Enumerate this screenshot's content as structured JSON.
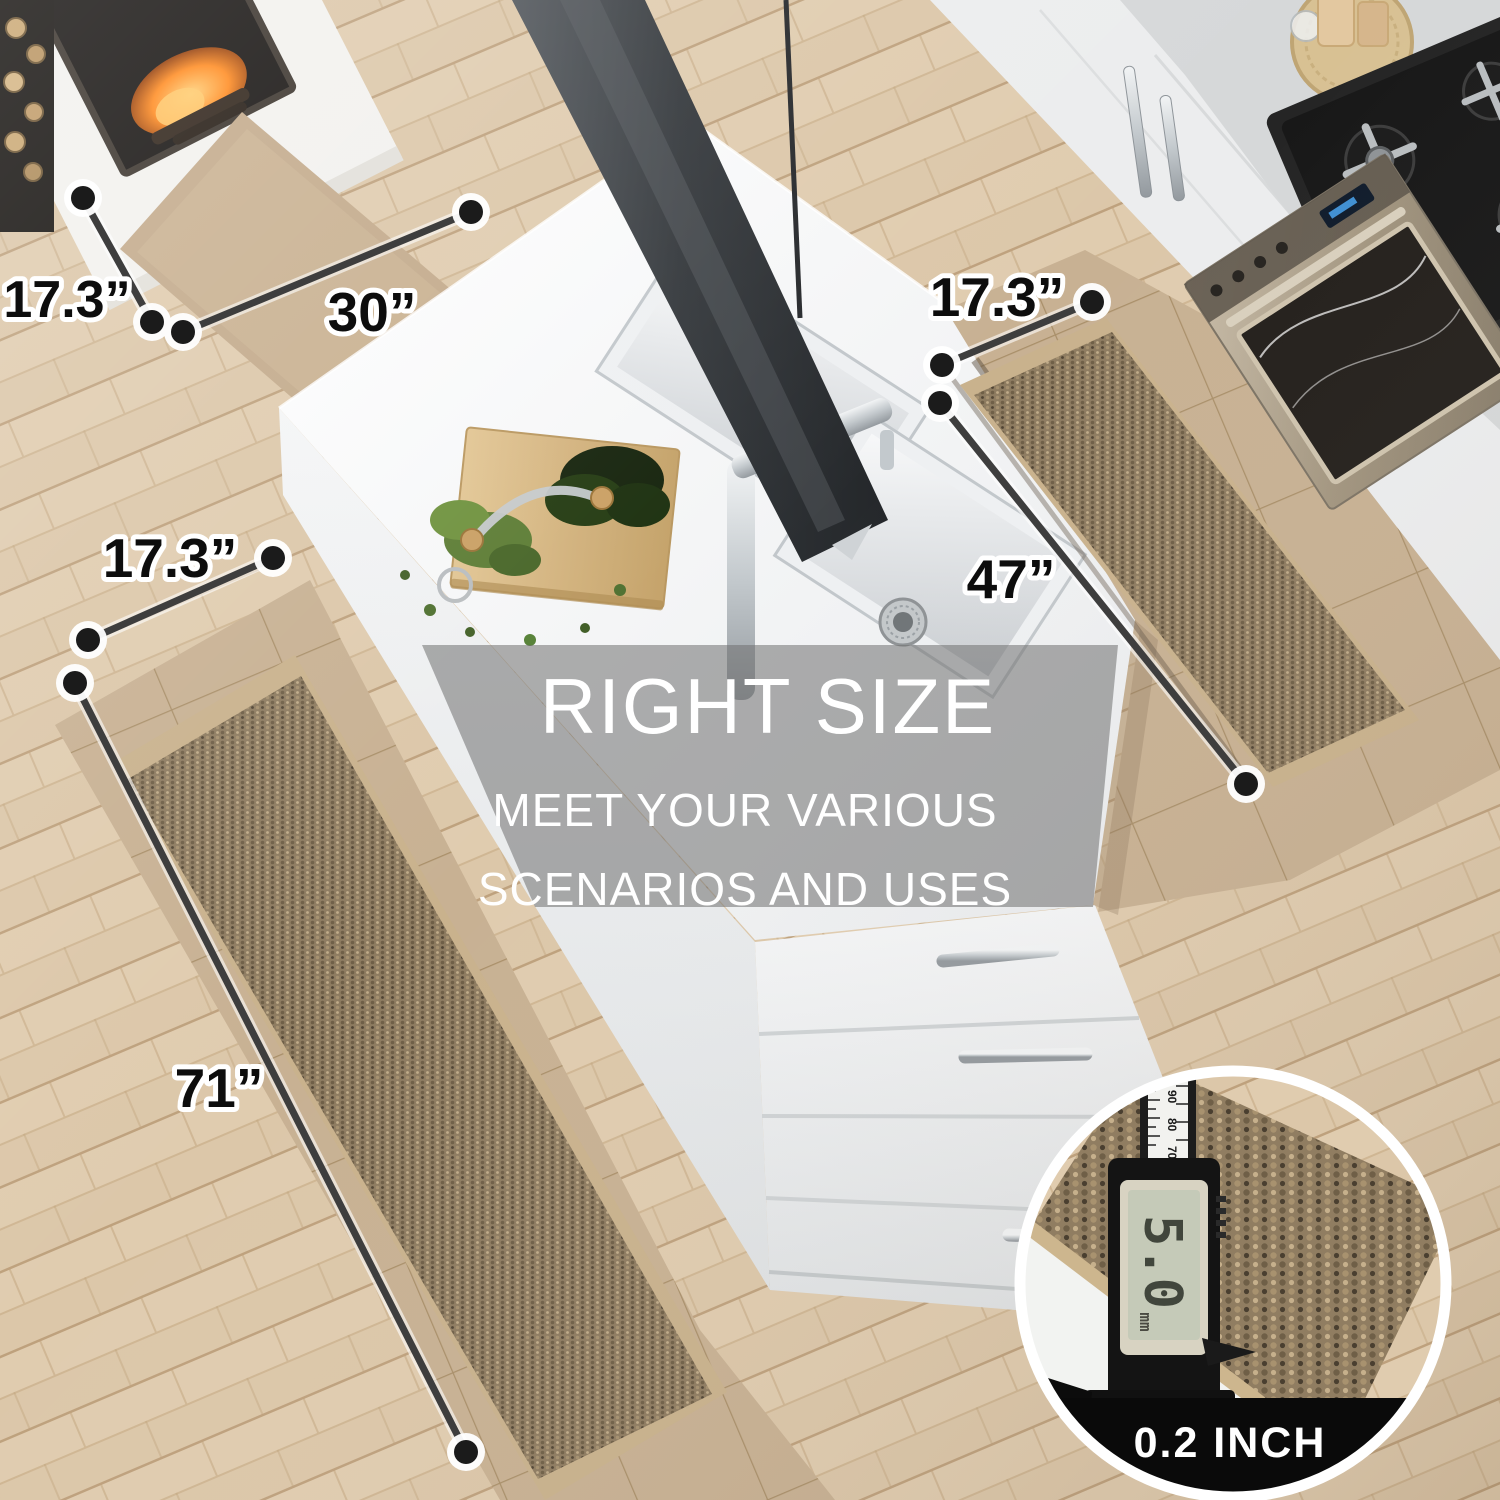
{
  "overlay": {
    "title": "RIGHT SIZE",
    "subtitle_line1": "MEET YOUR VARIOUS",
    "subtitle_line2": "SCENARIOS AND USES"
  },
  "annotations": {
    "fireplace_mat": {
      "width_label": "17.3”",
      "length_label": "30”"
    },
    "oven_runner": {
      "width_label": "17.3”",
      "length_label": "47”"
    },
    "long_runner": {
      "width_label": "17.3”",
      "length_label": "71”"
    }
  },
  "thickness_inset": {
    "caliper_reading": "5.0",
    "caliper_unit": "mm",
    "ruler_marks": [
      "90",
      "80",
      "70"
    ],
    "caption": "0.2 INCH"
  },
  "colors": {
    "rug_weave": "#8d7b60",
    "rug_border": "#c9b28d",
    "floor": "#dcc7a9",
    "tile": "#c8b193",
    "overlay_band": "#6f6f6f",
    "annotation_text": "#0d0d0d",
    "island": "#f7f8f8"
  }
}
